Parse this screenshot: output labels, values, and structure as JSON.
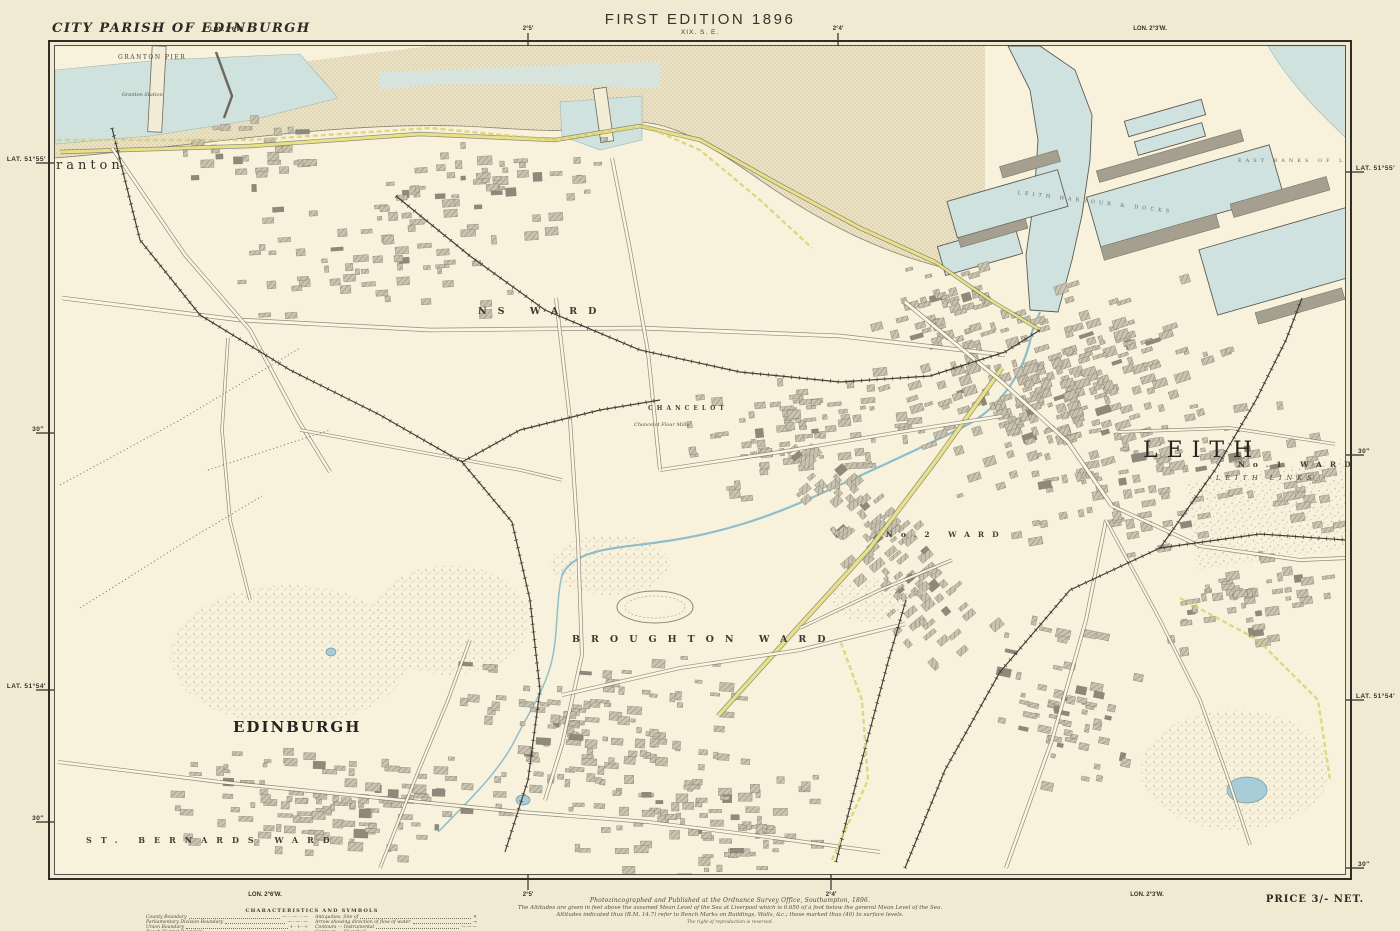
{
  "header": {
    "parish_title": "CITY PARISH OF EDINBURGH",
    "parish_lon": "LON. 2°6′W.",
    "edition": "FIRST EDITION 1896",
    "sheet": "XIX. S. E.",
    "tick_a": "2°5′",
    "tick_b": "2°4′",
    "lon_right": "LON. 2°3′W."
  },
  "left_margin": {
    "lat_top": "LAT. 51°55′",
    "tick_mid": "30″",
    "lat_bottom": "LAT. 51°54′",
    "tick_low": "30″"
  },
  "right_margin": {
    "lat_top": "LAT. 51°55′",
    "tick_mid": "30″",
    "lat_bottom": "LAT. 51°54′",
    "tick_low": "30″"
  },
  "footer": {
    "lon_left": "LON. 2°6′W.",
    "tick_a": "2°5′",
    "tick_b": "2°4′",
    "lon_right": "LON. 2°3′W.",
    "price": "PRICE 3/- NET.",
    "imprint": [
      "Photozincographed and Published at the Ordnance Survey Office, Southampton, 1896.",
      "The Altitudes are given in feet above the assumed Mean Level of the Sea at Liverpool which is 0.650 of a foot below the general Mean Level of the Sea.",
      "Altitudes indicated thus (B.M. 14.7) refer to Bench Marks on Buildings, Walls, &c.; those marked thus (40) to surface levels.",
      "The right of reproduction is reserved."
    ]
  },
  "legend": {
    "title": "CHARACTERISTICS AND SYMBOLS",
    "left": [
      {
        "label": "County Boundary",
        "sample": "—··—··—"
      },
      {
        "label": "Parliamentary Division Boundary",
        "sample": "—·—·—"
      },
      {
        "label": "Union Boundary",
        "sample": "+·+·+"
      },
      {
        "label": "Burgh District Boundary",
        "sample": "+ + + +"
      },
      {
        "label": "Parish Boundary",
        "sample": "·······"
      }
    ],
    "right": [
      {
        "label": "Antiquities, Site of",
        "sample": "✕"
      },
      {
        "label": "Arrow showing direction of flow of water",
        "sample": "→"
      },
      {
        "label": "Contours — Instrumental",
        "sample": "———"
      },
      {
        "label": "Contours — Sketched",
        "sample": "·····"
      },
      {
        "label": "Trigonometrical Station",
        "sample": "△"
      }
    ]
  },
  "map": {
    "labels": [
      {
        "text": "GRANTON PIER",
        "x": 118,
        "y": 54,
        "cls": "lbl-tiny-caps"
      },
      {
        "text": "Granton Station",
        "x": 122,
        "y": 92,
        "cls": "lbl-micro-it"
      },
      {
        "text": "ranton",
        "x": 56,
        "y": 158,
        "cls": "lbl-place"
      },
      {
        "text": "NS WARD",
        "x": 478,
        "y": 306,
        "cls": "lbl-ward"
      },
      {
        "text": "CHANCELOT",
        "x": 648,
        "y": 405,
        "cls": "lbl-spread-xs"
      },
      {
        "text": "Chancelot Flour Mills",
        "x": 634,
        "y": 422,
        "cls": "lbl-micro-it"
      },
      {
        "text": "LEITH",
        "x": 1143,
        "y": 438,
        "cls": "lbl-big"
      },
      {
        "text": "No.1 WARD",
        "x": 1238,
        "y": 460,
        "cls": "lbl-ward-sm"
      },
      {
        "text": "LEITH LINKS",
        "x": 1216,
        "y": 474,
        "cls": "lbl-area-it"
      },
      {
        "text": "No.2 WARD",
        "x": 886,
        "y": 530,
        "cls": "lbl-ward-sm"
      },
      {
        "text": "BROUGHTON WARD",
        "x": 572,
        "y": 634,
        "cls": "lbl-ward"
      },
      {
        "text": "EDINBURGH",
        "x": 233,
        "y": 718,
        "cls": "lbl-town"
      },
      {
        "text": "ST. BERNARDS WARD",
        "x": 86,
        "y": 835,
        "cls": "lbl-ward-sm2"
      },
      {
        "text": "EAST BANKS OF L",
        "x": 1238,
        "y": 158,
        "cls": "lbl-micro-sp"
      },
      {
        "text": "LEITH HARBOUR & DOCKS",
        "x": 1018,
        "y": 190,
        "cls": "lbl-micro-sp",
        "rot": 7
      }
    ]
  }
}
